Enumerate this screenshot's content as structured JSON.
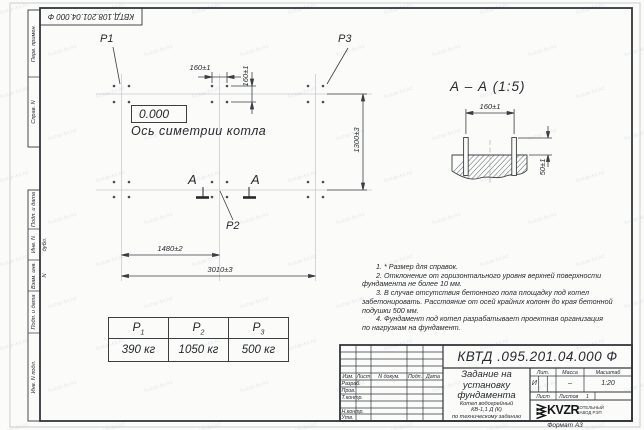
{
  "sheet": {
    "corner_stamp": "КВТД.108.201.04.000 Ф",
    "format_label": "Формат А3",
    "watermark_text": "kvzar-kv.kz",
    "margin_top": [
      "Перв. примен.",
      "Справ. N"
    ],
    "margin_bottom": [
      "Подп. и дата",
      "Инв. N дубл.",
      "Взам. инв. N",
      "Подп. и дата",
      "Инв. N подл."
    ]
  },
  "plan": {
    "elevation": "0.000",
    "axis_label": "Ось симетрии котла",
    "p1": "P1",
    "p2": "P2",
    "p3": "P3",
    "section_letter": "А",
    "dim_160_h": "160±1",
    "dim_160_v": "160±1",
    "dim_1300": "1300±3",
    "dim_1480": "1480±2",
    "dim_3010": "3010±3"
  },
  "section_view": {
    "title": "А – А (1:5)",
    "dim_160": "160±1",
    "dim_50": "50±1"
  },
  "load_table": {
    "headers": [
      {
        "base": "P",
        "sub": "1"
      },
      {
        "base": "P",
        "sub": "2"
      },
      {
        "base": "P",
        "sub": "3"
      }
    ],
    "values": [
      "390 кг",
      "1050 кг",
      "500 кг"
    ]
  },
  "notes": {
    "lines": [
      "1. * Размер для справок.",
      "2. Отклонение от горизонтального уровня верхней поверхности",
      "фундамента не более 10 мм.",
      "3. В случае отсутствия бетонного пола площадку под котел",
      "забетонировать. Расстояние от осей крайних колонн до края бетонной",
      "подушки 500 мм.",
      "4. Фундамент под котел разрабатывает проектная организация",
      "по нагрузкам на фундамент."
    ]
  },
  "title_block": {
    "doc_number": "КВТД .095.201.04.000 Ф",
    "title_line1": "Задание на",
    "title_line2": "установку",
    "title_line3": "фундамента",
    "subtitle_line1": "Котел водогрейный",
    "subtitle_line2": "КВ-1,1 Д (К)",
    "subtitle_line3": "по техническому заданию",
    "col_izm": "Изм.",
    "col_list": "Лист",
    "col_ndok": "N докум.",
    "col_podp": "Подп.",
    "col_data": "Дата",
    "row_razrab": "Разраб.",
    "row_prov": "Пров.",
    "row_tkontr": "Т.контр.",
    "row_nkontr": "Н.контр.",
    "row_utv": "Утв.",
    "lit_header": "Лит.",
    "mass_header": "Масса",
    "scale_header": "Масштаб",
    "lit_value": "И",
    "mass_value": "–",
    "scale_value": "1:20",
    "list_label": "Лист",
    "listov_label": "Листов",
    "listov_value": "1",
    "logo_text": "KVZR",
    "logo_caption1": "КОТЕЛЬНЫЙ",
    "logo_caption2": "ЗАВОД РЭП"
  }
}
